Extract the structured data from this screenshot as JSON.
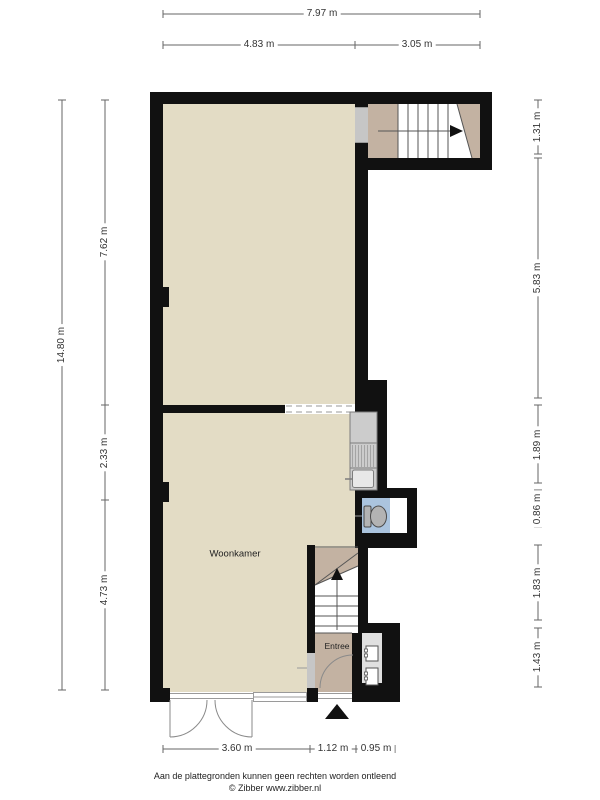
{
  "plan": {
    "title": "floor-plan",
    "rooms": [
      {
        "name": "Woonkamer"
      },
      {
        "name": "Entree"
      }
    ]
  },
  "dimensions": {
    "top": [
      "7.97 m",
      "4.83 m",
      "3.05 m"
    ],
    "left": [
      "14.80 m",
      "7.62 m",
      "2.33 m",
      "4.73 m"
    ],
    "right": [
      "1.31 m",
      "5.83 m",
      "1.89 m",
      "0.86 m",
      "1.83 m",
      "1.43 m"
    ],
    "bottom": [
      "3.60 m",
      "1.12 m",
      "0.95 m"
    ]
  },
  "footer": {
    "disclaimer": "Aan de plattegronden kunnen geen rechten worden ontleend",
    "copyright": "© Zibber www.zibber.nl"
  },
  "colors": {
    "wall": "#111111",
    "floor": "#e3dcc5",
    "stair_landing": "#c3b2a2",
    "toilet_floor": "#abc4de"
  }
}
